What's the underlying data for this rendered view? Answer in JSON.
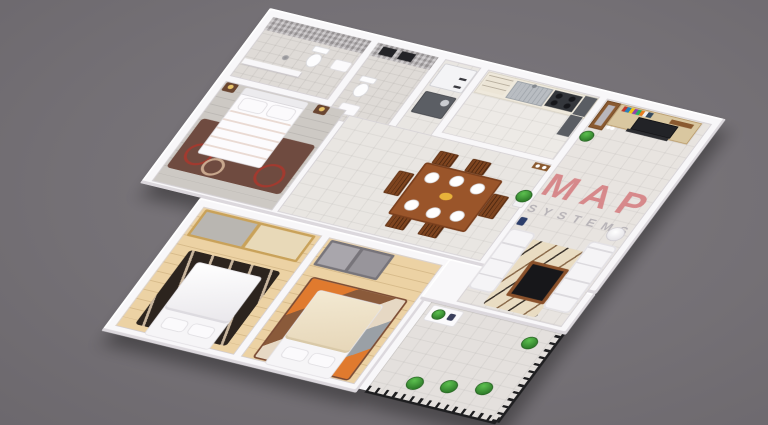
{
  "scene": {
    "title": "3d-apartment-floor-plan-render",
    "background_color": "#747075",
    "watermark": {
      "line1": "MAP",
      "line2": "SYSTEMS",
      "line1_color": "#d4797c",
      "line2_color": "#aeabb0"
    },
    "palette": {
      "wall_white": "#f8f7f9",
      "tile_floor": "#e9e6e2",
      "bath_tile_wall": "#b4afb1",
      "wood_floor": "#ecd2a4",
      "gray_plank_floor": "#cdc9c4",
      "orange_blanket": "#ee9a6c",
      "rug_brown": "#6f4b40",
      "rug_ring_red": "#a23a2f",
      "dining_wood": "#9a552a",
      "tv_panel_tan": "#d9c7a0",
      "granite_dark": "#5a5d63",
      "stove_dark": "#34373c",
      "railing_black": "#1e1e20",
      "plant_green": "#2f7d2a",
      "wardrobe_gold_trim": "#c9a25a"
    },
    "rooms": [
      {
        "name": "bathroom-1",
        "contents": [
          "toilet",
          "pedestal-sink",
          "floor-drain",
          "mosaic-tile-walls"
        ]
      },
      {
        "name": "bathroom-2",
        "contents": [
          "toilet",
          "wall-sink",
          "ventilation-windows",
          "mosaic-tile-walls"
        ]
      },
      {
        "name": "utility-nook",
        "contents": [
          "refrigerator",
          "washing-machine"
        ]
      },
      {
        "name": "kitchen",
        "contents": [
          "drawer-cabinets",
          "steel-sink",
          "gas-stove",
          "granite-counter"
        ]
      },
      {
        "name": "master-bedroom",
        "contents": [
          "double-bed-orange-blanket",
          "pillows",
          "nightstand-left",
          "nightstand-right",
          "table-lamps",
          "circle-pattern-rug"
        ]
      },
      {
        "name": "dining-hall",
        "contents": [
          "dining-table",
          "six-chairs",
          "six-plates",
          "centerpiece",
          "potted-plant",
          "wall-shelf-with-vases"
        ]
      },
      {
        "name": "living-room",
        "contents": [
          "tv-wall-unit",
          "flat-tv",
          "book-shelf",
          "display-cabinet",
          "soundbar",
          "two-white-sofas",
          "coffee-table",
          "striped-cream-rug",
          "floor-lamp",
          "potted-plant",
          "decor-vases"
        ]
      },
      {
        "name": "bedroom-2",
        "contents": [
          "sliding-wardrobe-gold-trim",
          "double-bed-white",
          "zebra-rug"
        ]
      },
      {
        "name": "bedroom-3",
        "contents": [
          "sliding-wardrobe-gray",
          "double-bed-cream",
          "patchwork-rug"
        ]
      },
      {
        "name": "balcony",
        "contents": [
          "black-metal-railing",
          "three-topiary-plants",
          "white-planter-box",
          "small-tree"
        ]
      }
    ]
  }
}
